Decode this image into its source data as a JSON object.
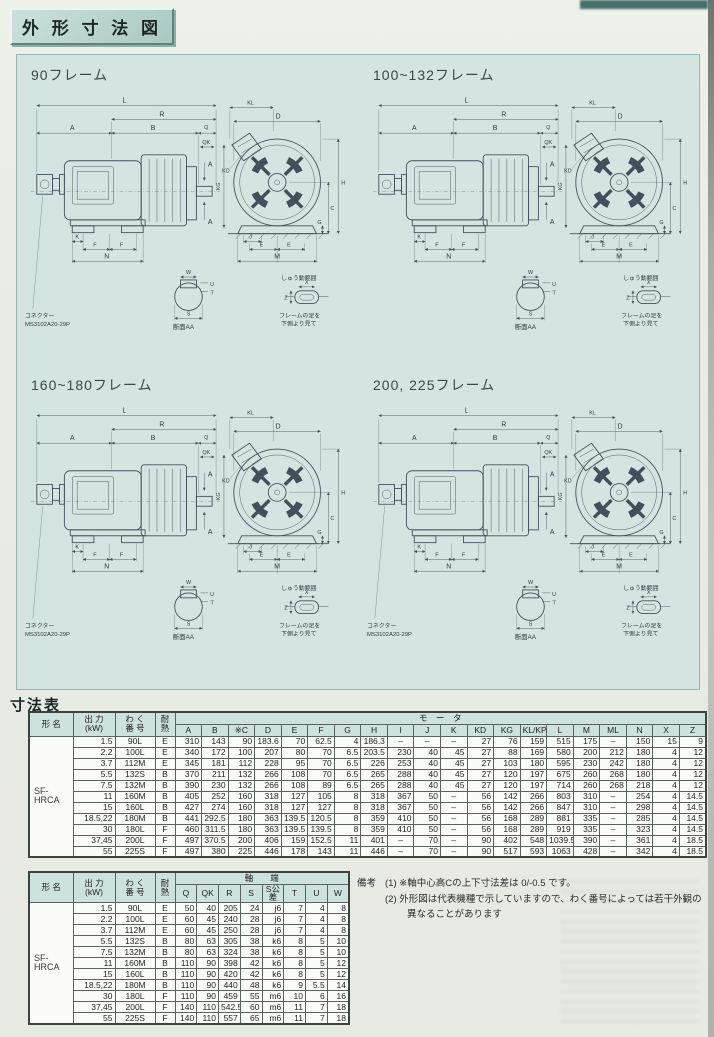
{
  "page": {
    "title": "外 形 寸 法 図",
    "dim_table_heading": "寸法表"
  },
  "sections": [
    {
      "title": "90フレーム",
      "show_connector": true
    },
    {
      "title": "100~132フレーム",
      "show_connector": false
    },
    {
      "title": "160~180フレーム",
      "show_connector": true
    },
    {
      "title": "200, 225フレーム",
      "show_connector": true
    }
  ],
  "diagram_labels": {
    "L": "L",
    "R": "R",
    "A": "A",
    "B": "B",
    "Q": "Q",
    "QK": "QK",
    "K": "K",
    "F": "F",
    "N": "N",
    "KL": "KL",
    "D": "D",
    "KD": "KD",
    "KG": "KG",
    "C": "C",
    "G": "G",
    "H": "H",
    "J": "J",
    "E": "E",
    "M": "M",
    "W": "W",
    "S": "S",
    "T": "T",
    "U": "U",
    "X": "X",
    "Z": "Z",
    "section_aa": "断面AA",
    "slide_note": "しゅう動範囲",
    "foot_view_note1": "フレームの足を",
    "foot_view_note2": "下側より見て",
    "connector_line1": "コネクター",
    "connector_line2": "MS3102A20-29P"
  },
  "table1": {
    "left_headers": [
      "形 名",
      "出 力\n(kW)",
      "わ く\n番 号",
      "耐\n熱"
    ],
    "group_header": "モ　ー　タ",
    "columns": [
      "A",
      "B",
      "※C",
      "D",
      "E",
      "F",
      "G",
      "H",
      "I",
      "J",
      "K",
      "KD",
      "KG",
      "KL/KP",
      "L",
      "M",
      "ML",
      "N",
      "X",
      "Z"
    ],
    "model": "SF-\nHRCA",
    "rows": [
      {
        "output": "1.5",
        "frame": "90L",
        "heat": "E",
        "values": [
          "310",
          "143",
          "90",
          "183.6",
          "70",
          "62.5",
          "4",
          "186.3",
          "–",
          "–",
          "–",
          "27",
          "76",
          "159",
          "515",
          "175",
          "–",
          "150",
          "15",
          "9"
        ]
      },
      {
        "output": "2.2",
        "frame": "100L",
        "heat": "E",
        "values": [
          "340",
          "172",
          "100",
          "207",
          "80",
          "70",
          "6.5",
          "203.5",
          "230",
          "40",
          "45",
          "27",
          "88",
          "169",
          "580",
          "200",
          "212",
          "180",
          "4",
          "12"
        ]
      },
      {
        "output": "3.7",
        "frame": "112M",
        "heat": "E",
        "values": [
          "345",
          "181",
          "112",
          "228",
          "95",
          "70",
          "6.5",
          "226",
          "253",
          "40",
          "45",
          "27",
          "103",
          "180",
          "595",
          "230",
          "242",
          "180",
          "4",
          "12"
        ]
      },
      {
        "output": "5.5",
        "frame": "132S",
        "heat": "B",
        "values": [
          "370",
          "211",
          "132",
          "266",
          "108",
          "70",
          "6.5",
          "265",
          "288",
          "40",
          "45",
          "27",
          "120",
          "197",
          "675",
          "260",
          "268",
          "180",
          "4",
          "12"
        ]
      },
      {
        "output": "7.5",
        "frame": "132M",
        "heat": "B",
        "values": [
          "390",
          "230",
          "132",
          "266",
          "108",
          "89",
          "6.5",
          "265",
          "288",
          "40",
          "45",
          "27",
          "120",
          "197",
          "714",
          "260",
          "268",
          "218",
          "4",
          "12"
        ]
      },
      {
        "output": "11",
        "frame": "160M",
        "heat": "B",
        "values": [
          "405",
          "252",
          "160",
          "318",
          "127",
          "105",
          "8",
          "318",
          "367",
          "50",
          "–",
          "56",
          "142",
          "266",
          "803",
          "310",
          "–",
          "254",
          "4",
          "14.5"
        ]
      },
      {
        "output": "15",
        "frame": "160L",
        "heat": "B",
        "values": [
          "427",
          "274",
          "160",
          "318",
          "127",
          "127",
          "8",
          "318",
          "367",
          "50",
          "–",
          "56",
          "142",
          "266",
          "847",
          "310",
          "–",
          "298",
          "4",
          "14.5"
        ]
      },
      {
        "output": "18.5,22",
        "frame": "180M",
        "heat": "B",
        "values": [
          "441",
          "292.5",
          "180",
          "363",
          "139.5",
          "120.5",
          "8",
          "359",
          "410",
          "50",
          "–",
          "56",
          "168",
          "289",
          "881",
          "335",
          "–",
          "285",
          "4",
          "14.5"
        ]
      },
      {
        "output": "30",
        "frame": "180L",
        "heat": "F",
        "values": [
          "460",
          "311.5",
          "180",
          "363",
          "139.5",
          "139.5",
          "8",
          "359",
          "410",
          "50",
          "–",
          "56",
          "168",
          "289",
          "919",
          "335",
          "–",
          "323",
          "4",
          "14.5"
        ]
      },
      {
        "output": "37,45",
        "frame": "200L",
        "heat": "F",
        "values": [
          "497",
          "370.5",
          "200",
          "406",
          "159",
          "152.5",
          "11",
          "401",
          "–",
          "70",
          "–",
          "90",
          "402",
          "548",
          "1039.5",
          "390",
          "–",
          "361",
          "4",
          "18.5"
        ]
      },
      {
        "output": "55",
        "frame": "225S",
        "heat": "F",
        "values": [
          "497",
          "380",
          "225",
          "446",
          "178",
          "143",
          "11",
          "446",
          "–",
          "70",
          "–",
          "90",
          "517",
          "593",
          "1063",
          "428",
          "–",
          "342",
          "4",
          "18.5"
        ]
      }
    ]
  },
  "table2": {
    "left_headers": [
      "形 名",
      "出 力\n(kW)",
      "わ く\n番 号",
      "耐\n熱"
    ],
    "group_header": "軸　　端",
    "columns": [
      "Q",
      "QK",
      "R",
      "S",
      "S公差",
      "T",
      "U",
      "W"
    ],
    "model": "SF-\nHRCA",
    "rows": [
      {
        "output": "1.5",
        "frame": "90L",
        "heat": "E",
        "values": [
          "50",
          "40",
          "205",
          "24",
          "j6",
          "7",
          "4",
          "8"
        ]
      },
      {
        "output": "2.2",
        "frame": "100L",
        "heat": "E",
        "values": [
          "60",
          "45",
          "240",
          "28",
          "j6",
          "7",
          "4",
          "8"
        ]
      },
      {
        "output": "3.7",
        "frame": "112M",
        "heat": "E",
        "values": [
          "60",
          "45",
          "250",
          "28",
          "j6",
          "7",
          "4",
          "8"
        ]
      },
      {
        "output": "5.5",
        "frame": "132S",
        "heat": "B",
        "values": [
          "80",
          "63",
          "305",
          "38",
          "k6",
          "8",
          "5",
          "10"
        ]
      },
      {
        "output": "7.5",
        "frame": "132M",
        "heat": "B",
        "values": [
          "80",
          "63",
          "324",
          "38",
          "k6",
          "8",
          "5",
          "10"
        ]
      },
      {
        "output": "11",
        "frame": "160M",
        "heat": "B",
        "values": [
          "110",
          "90",
          "398",
          "42",
          "k6",
          "8",
          "5",
          "12"
        ]
      },
      {
        "output": "15",
        "frame": "160L",
        "heat": "B",
        "values": [
          "110",
          "90",
          "420",
          "42",
          "k6",
          "8",
          "5",
          "12"
        ]
      },
      {
        "output": "18.5,22",
        "frame": "180M",
        "heat": "B",
        "values": [
          "110",
          "90",
          "440",
          "48",
          "k6",
          "9",
          "5.5",
          "14"
        ]
      },
      {
        "output": "30",
        "frame": "180L",
        "heat": "F",
        "values": [
          "110",
          "90",
          "459",
          "55",
          "m6",
          "10",
          "6",
          "16"
        ]
      },
      {
        "output": "37,45",
        "frame": "200L",
        "heat": "F",
        "values": [
          "140",
          "110",
          "542.5",
          "60",
          "m6",
          "11",
          "7",
          "18"
        ]
      },
      {
        "output": "55",
        "frame": "225S",
        "heat": "F",
        "values": [
          "140",
          "110",
          "557",
          "65",
          "m6",
          "11",
          "7",
          "18"
        ]
      }
    ]
  },
  "remarks": {
    "label": "備考",
    "items": [
      "(1) ※軸中心高Cの上下寸法差は 0/-0.5 です。",
      "(2) 外形図は代表機種で示していますので、わく番号によっては若干外観の異なることがあります"
    ]
  }
}
